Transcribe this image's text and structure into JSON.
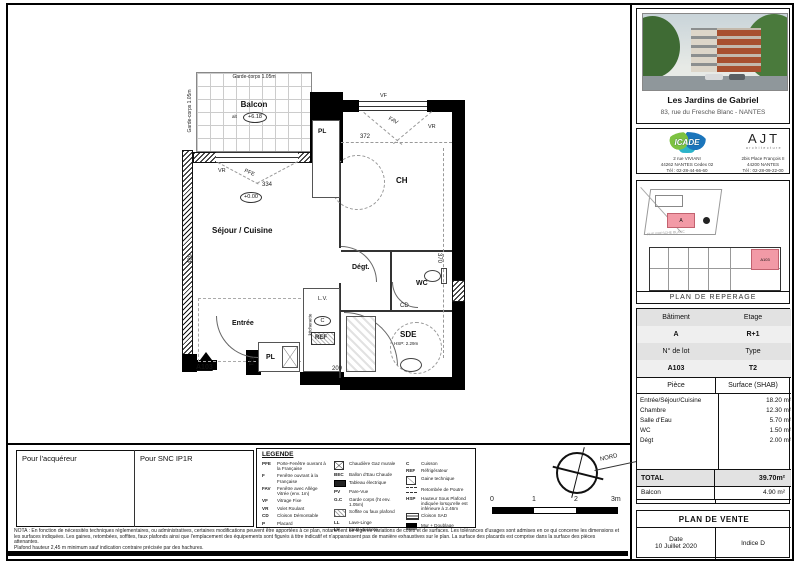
{
  "colors": {
    "highlight": "#f29aa6",
    "wall": "#000000"
  },
  "plan": {
    "balcon": "Balcon",
    "balcon_level_prefix": "alt",
    "balcon_level": "+6.18",
    "level_zero": "+0.00",
    "garde_corps_top": "Garde-corps 1.05m",
    "garde_corps_left": "Garde-corps 1.05m",
    "sejour": "Séjour / Cuisine",
    "entree": "Entrée",
    "chambre": "CH",
    "degagement": "Dégt.",
    "wc": "WC",
    "sde": "SDE",
    "hsp": "HSP: 2.29m",
    "pl_top": "PL",
    "pl_bottom": "PL",
    "tel": "TEL",
    "kitchenette": "kitchenette",
    "lv": "L.V.",
    "cuisson": "C",
    "ref": "REF",
    "cd": "CD",
    "lot": "A103",
    "dim_334": "334",
    "dim_489": "489",
    "dim_372": "372",
    "dim_370": "370",
    "dim_209": "209",
    "vf": "VF",
    "vr_balcon": "VR",
    "pfe": "PFE",
    "fav": "FAV",
    "vr_ch": "VR"
  },
  "signatures": {
    "left": "Pour l'acquéreur",
    "right": "Pour SNC IP1R"
  },
  "legend": {
    "title": "LEGENDE",
    "col1": [
      {
        "abbr": "PFE",
        "label": "Porte-Fenêtre ouvrant à la Française"
      },
      {
        "abbr": "F",
        "label": "Fenêtre ouvrant à la Française"
      },
      {
        "abbr": "FAV",
        "label": "Fenêtre avec Allège Vitrée (env. 1m)"
      },
      {
        "abbr": "VF",
        "label": "Vitrage Fixe"
      },
      {
        "abbr": "VR",
        "label": "Volet Roulant"
      },
      {
        "abbr": "CD",
        "label": "Cloison Démontable"
      },
      {
        "abbr": "P",
        "label": "Placard"
      }
    ],
    "col2": [
      {
        "abbr": "",
        "label": "Chaudière Gaz murale"
      },
      {
        "abbr": "BEC",
        "label": "Ballon d'Eau Chaude"
      },
      {
        "abbr": "",
        "label": "Tableau électrique"
      },
      {
        "abbr": "PV",
        "label": "Pare-Vue"
      },
      {
        "abbr": "G.C",
        "label": "Garde corps (ht env. 1.05m)"
      },
      {
        "abbr": "",
        "label": "Soffite ou faux plafond"
      },
      {
        "abbr": "LL",
        "label": "Lave-Linge"
      },
      {
        "abbr": "LV",
        "label": "Lave-vaisselle"
      }
    ],
    "col3": [
      {
        "abbr": "C",
        "label": "Cuisson"
      },
      {
        "abbr": "REF",
        "label": "Réfrigérateur"
      },
      {
        "abbr": "",
        "label": "Gaine technique"
      },
      {
        "abbr": "",
        "label": "Retombée de Poutre"
      },
      {
        "abbr": "HSP",
        "label": "Hauteur Sous Plafond indiquée lorsqu'elle est inférieure à 2.46m"
      },
      {
        "abbr": "",
        "label": "Cloison SAD"
      },
      {
        "abbr": "",
        "label": "Mur + Doublage"
      }
    ]
  },
  "scalebar": {
    "t0": "0",
    "t1": "1",
    "t2": "2",
    "t3": "3m"
  },
  "north": "NORD",
  "nota": {
    "line1": "NOTA : En fonction de nécessités techniques réglementaires, ou administratives, certaines modifications peuvent être apportées à ce plan, notamment de légères variations de côtes et de surfaces. Les tolérances d'usages sont admises en ce qui concerne les dimensions et les surfaces indiquées. Les gaines, retombées, soffites, faux plafonds ainsi que l'emplacement des équipements sont figurés à titre indicatif et n'apparaissent pas de manière exhaustives sur le plan. La surface des placards est comprise dans la surface des pièces attenantes.",
    "line2": "Plafond hauteur 2,45 m minimum sauf indication contraire précisée par des hachures."
  },
  "sidebar": {
    "project": {
      "title": "Les Jardins de Gabriel",
      "address": "83, rue du Fresche Blanc - NANTES"
    },
    "icade": {
      "name": "ICADE",
      "line1": "2 rue VIVIANI",
      "line2": "44262 NANTES Cedex 02",
      "line3": "Tél : 02-28-44-66-60"
    },
    "ajt": {
      "name": "AJT",
      "sub": "architecture",
      "line1": "2bis Place François II",
      "line2": "44200 NANTES",
      "line3": "Tél : 02-28-09-22-00"
    },
    "reperage": {
      "caption": "PLAN DE REPERAGE",
      "site_label": "A",
      "unit_label": "A103",
      "street": "RUE FRESCHE BLANC"
    },
    "table": {
      "batiment_label": "Bâtiment",
      "etage_label": "Etage",
      "batiment": "A",
      "etage": "R+1",
      "lot_label": "N° de lot",
      "type_label": "Type",
      "lot": "A103",
      "type": "T2",
      "piece_label": "Pièce",
      "surface_label": "Surface (SHAB)",
      "rows": [
        [
          "Entrée/Séjour/Cuisine",
          "18.20 m²"
        ],
        [
          "Chambre",
          "12.30 m²"
        ],
        [
          "Salle d'Eau",
          "5.70 m²"
        ],
        [
          "WC",
          "1.50 m²"
        ],
        [
          "Dégt",
          "2.00 m²"
        ]
      ],
      "total_label": "TOTAL",
      "total": "39.70m²",
      "balcon_label": "Balcon",
      "balcon": "4.90 m²"
    },
    "vente": {
      "title": "PLAN DE VENTE",
      "date_label": "Date",
      "date": "10 Juillet 2020",
      "indice": "Indice D"
    }
  }
}
